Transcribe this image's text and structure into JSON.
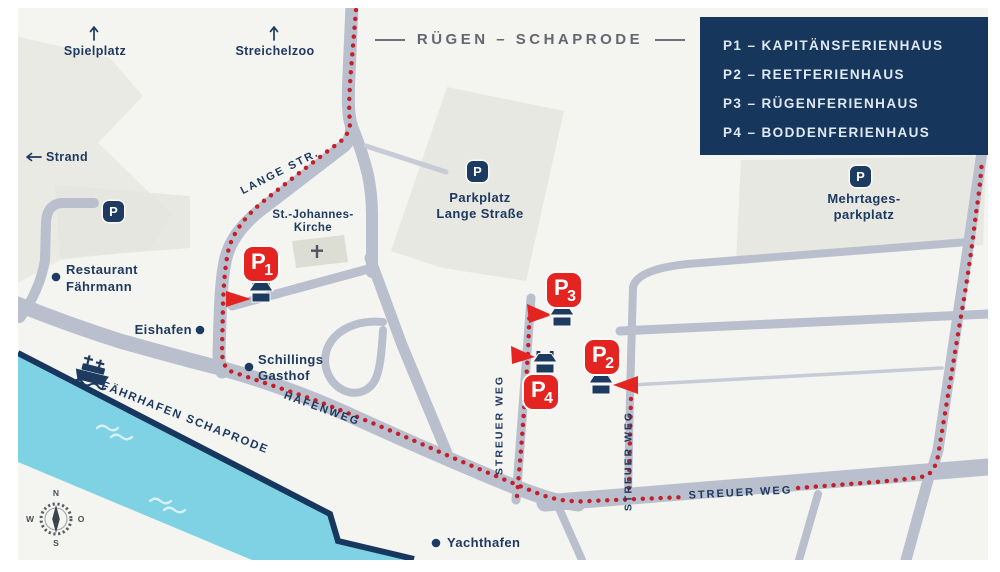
{
  "map": {
    "title": "RÜGEN – SCHAPRODE"
  },
  "legend": {
    "items": [
      "P1 – KAPITÄNSFERIENHAUS",
      "P2 – REETFERIENHAUS",
      "P3 – RÜGENFERIENHAUS",
      "P4 – BODDENFERIENHAUS"
    ]
  },
  "markers": {
    "p1": {
      "p": "P",
      "n": "1"
    },
    "p2": {
      "p": "P",
      "n": "2"
    },
    "p3": {
      "p": "P",
      "n": "3"
    },
    "p4": {
      "p": "P",
      "n": "4"
    }
  },
  "parking": {
    "letter": "P"
  },
  "edge": {
    "spielplatz": "Spielplatz",
    "streichelzoo": "Streichelzoo",
    "strand": "Strand"
  },
  "pois": {
    "restaurant": [
      "Restaurant",
      "Fährmann"
    ],
    "eishafen": "Eishafen",
    "schillings": [
      "Schillings",
      "Gasthof"
    ],
    "yachthafen": "Yachthafen",
    "kirche": [
      "St.-Johannes-",
      "Kirche"
    ],
    "parkplatz_lange": [
      "Parkplatz",
      "Lange Straße"
    ],
    "mehrtages": [
      "Mehrtages-",
      "parkplatz"
    ]
  },
  "streets": {
    "lange": "LANGE STR.",
    "hafenweg": "HAFENWEG",
    "faehrhafen": "FÄHRHAFEN SCHAPRODE",
    "streuer": "STREUER WEG"
  },
  "compass": {
    "n": "N",
    "w": "W",
    "o": "O",
    "s": "S"
  },
  "colors": {
    "navy": "#1d3a60",
    "legend_bg": "#16365c",
    "badge_red": "#e42420",
    "trail_red": "#c4202b",
    "street_gray": "#b9bfcc",
    "water_blue": "#7fd2e3",
    "area_gray": "#e8e9e3",
    "background": "#f4f4f1"
  }
}
